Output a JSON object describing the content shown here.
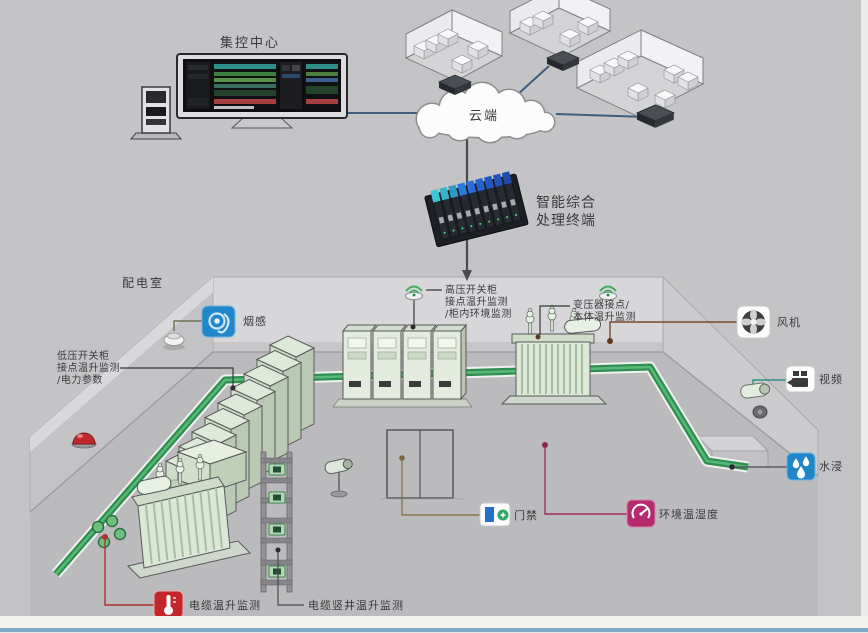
{
  "labels": {
    "control_center": "集控中心",
    "cloud": "云端",
    "terminal1": "智能综合",
    "terminal2": "处理终端",
    "room": "配电室",
    "smoke": "烟感",
    "fan": "风机",
    "video": "视频",
    "water": "水浸",
    "door": "门禁",
    "env": "环境温湿度",
    "cable_temp": "电缆温升监测",
    "cable_shaft": "电缆竖井温升监测",
    "lv1": "低压开关柜",
    "lv2": "接点温升监测",
    "lv3": "/电力参数",
    "hv1": "高压开关柜",
    "hv2": "接点温升监测",
    "hv3": "/柜内环境监测",
    "tx1": "变压器接点/",
    "tx2": "本体温升监测"
  },
  "icons": {
    "smoke": "swirl-on-blue-tile",
    "fan": "fan-blades-on-white-tile",
    "video": "camcorder-on-white-tile",
    "water": "three-drops-on-blue-tile",
    "door": "door-with-green-plus",
    "env": "gauge-on-magenta-tile",
    "cable_temp": "thermometer-on-red-tile",
    "wireless_sensor": "green-wifi-arcs-puck"
  },
  "colors": {
    "background": "#c4c4c6",
    "connection_line": "#3c5d7d",
    "device_line": "#4a4a4c",
    "cabinet_green": "#e4ecdf",
    "tray_green": "#2f8f4f",
    "sensor_blue": "#2187ca",
    "alarm_red": "#c5262c",
    "env_magenta": "#b52a6f",
    "water_blue": "#1f86c8",
    "beacon_red": "#c0282e"
  }
}
